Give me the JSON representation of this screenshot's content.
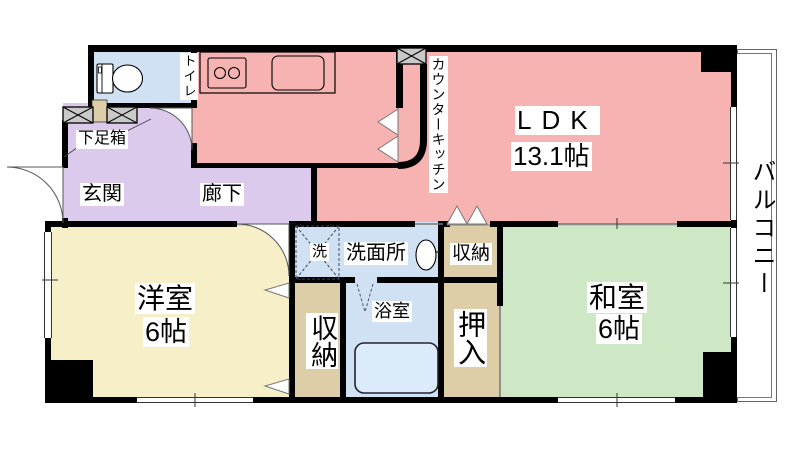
{
  "plan": {
    "title": "2LDK apartment floor plan",
    "rooms": {
      "ldk": {
        "name": "LDK",
        "size": "13.1帖"
      },
      "western": {
        "name": "洋室",
        "size": "6帖"
      },
      "japanese": {
        "name": "和室",
        "size": "6帖"
      },
      "entrance": {
        "name": "玄関"
      },
      "hallway": {
        "name": "廊下"
      },
      "toilet": {
        "name": "トイレ"
      },
      "shoe_box": {
        "name": "下足箱"
      },
      "counter_kitchen": {
        "name": "カウンターキッチン"
      },
      "washroom": {
        "name": "洗面所"
      },
      "washer": {
        "name": "洗"
      },
      "bathroom": {
        "name": "浴室"
      },
      "storage_upper": {
        "name": "収納"
      },
      "storage_lower": {
        "name": "収納"
      },
      "oshiire": {
        "name": "押入"
      },
      "balcony": {
        "name": "バルコニー"
      }
    },
    "icons": {
      "toilet_icon": "toilet bowl with tank",
      "stove_icon": "two-burner stove",
      "kitchen_sink_icon": "kitchen sink",
      "washbasin_icon": "oval wash basin",
      "bathtub_icon": "bathtub",
      "washer_pan_icon": "dashed square with X",
      "shoe_cabinet_icon": "hatched box",
      "duct_icon": "hatched box",
      "door_arc_icon": "door swing arc",
      "folding_door_icon": "white triangles"
    },
    "colors": {
      "wall": "#000000",
      "ldk": "#f7b2b2",
      "hall": "#dccaec",
      "water": "#cfe1f3",
      "western": "#f7efc8",
      "japanese": "#cee8c5",
      "closet": "#decea8",
      "hatch": "#c9c9c9",
      "tub": "#dcebfa"
    }
  }
}
